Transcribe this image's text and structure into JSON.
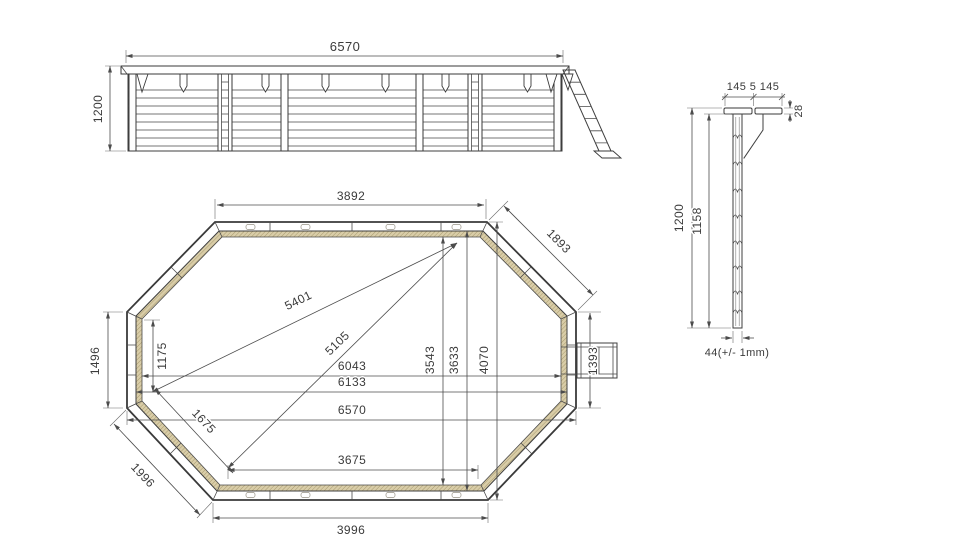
{
  "title": "Octagonal wooden pool technical drawing",
  "colors": {
    "line": "#3a3a3a",
    "liner_fill": "#d9cda8",
    "liner_hatch": "#a89a6e"
  },
  "elevation": {
    "width": "6570",
    "height": "1200"
  },
  "plan": {
    "top_edge": "3892",
    "top_right_edge": "1893",
    "diag_long": "5401",
    "diag_short": "5105",
    "width_6043": "6043",
    "width_6133": "6133",
    "width_6570": "6570",
    "bottom_inner": "3675",
    "bottom_edge": "3996",
    "left_edge": "1496",
    "left_inner": "1175",
    "bl_inner": "1675",
    "bl_edge": "1996",
    "v_3543": "3543",
    "v_3633": "3633",
    "v_4070": "4070",
    "right_edge": "1393"
  },
  "detail": {
    "rails": "145 5 145",
    "rail_thickness": "28",
    "height_total": "1200",
    "height_wall": "1158",
    "plank": "44(+/- 1mm)"
  }
}
